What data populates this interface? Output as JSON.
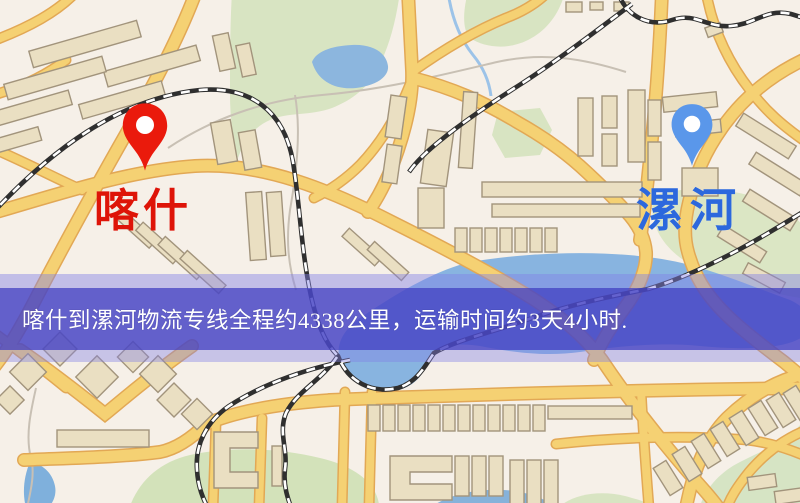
{
  "map": {
    "type": "logistics-route-map",
    "markers": [
      {
        "id": "kashi",
        "label": "喀什",
        "pin_color": "#ea1a0c",
        "label_color": "#de1408",
        "pin_style": "red-location-pin"
      },
      {
        "id": "luohe",
        "label": "漯河",
        "pin_color": "#5a97ea",
        "label_color": "#2c68dd",
        "pin_style": "blue-location-pin"
      }
    ],
    "banner": {
      "text": "喀什到漯河物流专线全程约4338公里，运输时间约3天4小时.",
      "background_color": "#4b49c5",
      "text_color": "#ffffff"
    },
    "route": {
      "origin": "喀什",
      "destination": "漯河",
      "distance_km": "4338",
      "duration": "3天4小时"
    },
    "palette": {
      "map_background": "#f6f0e8",
      "park_green": "#d8e4c2",
      "water_blue": "#8cb6de",
      "road_fill": "#f5d173",
      "road_casing": "#e2a855",
      "railway_dark": "#2f2f2f",
      "building_fill": "#eadfc2",
      "building_stroke": "#a2947c"
    }
  }
}
